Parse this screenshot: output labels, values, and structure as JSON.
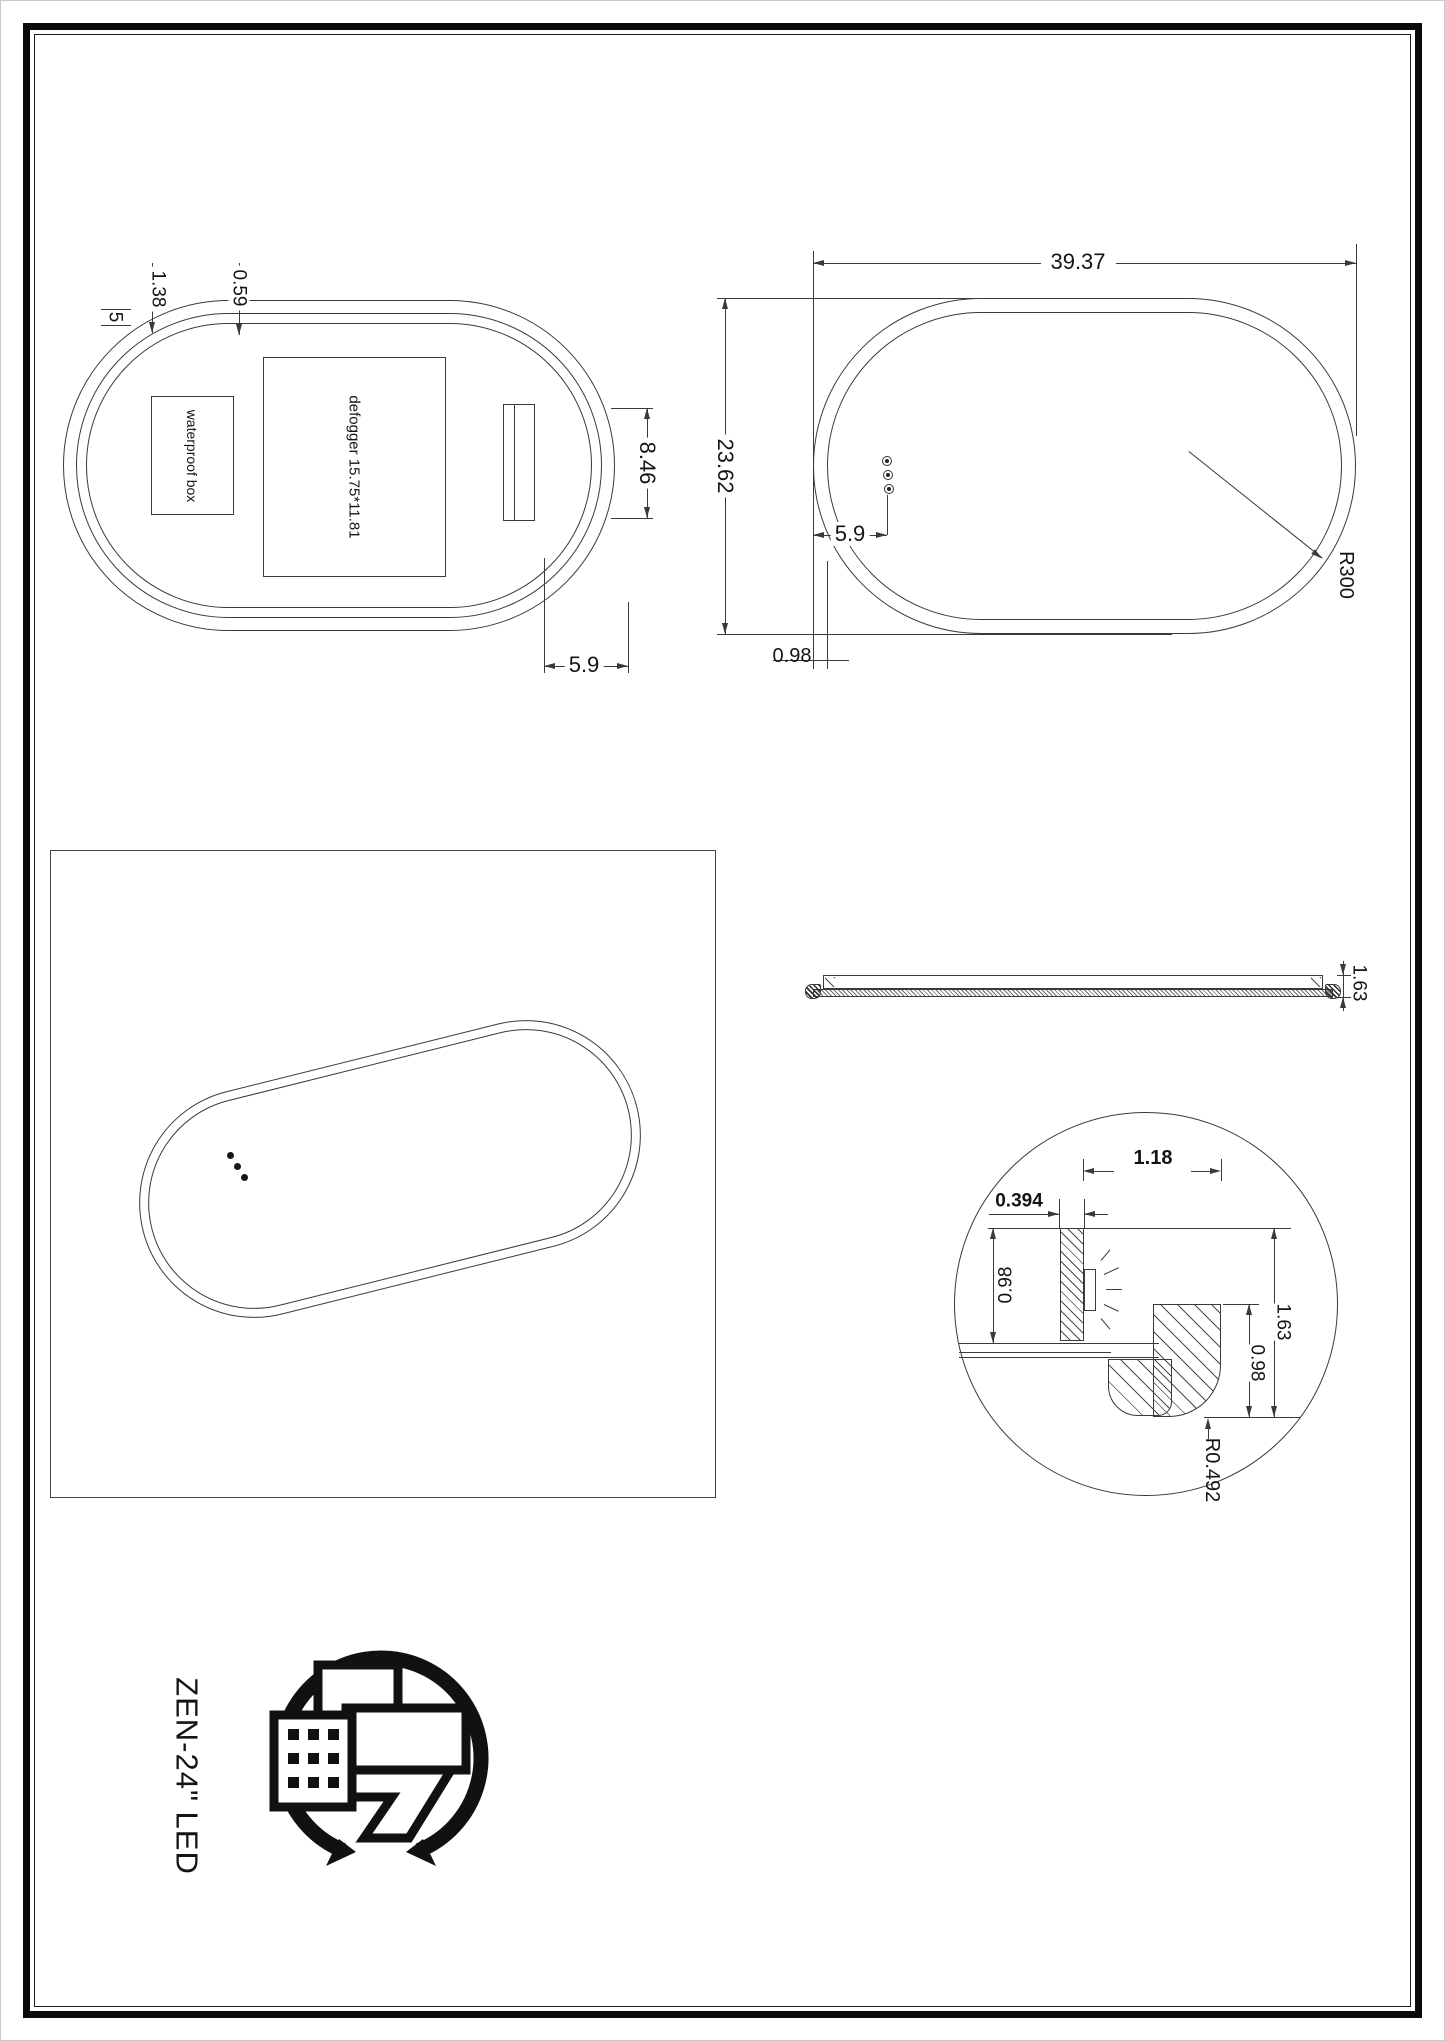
{
  "colors": {
    "line": "#3a3a3a",
    "text": "#141414",
    "frame": "#0b0b0b"
  },
  "rear_view": {
    "dims": {
      "edge_gap": "5",
      "flange": "1.38",
      "inner_offset": "0.59",
      "bracket_height": "8.46",
      "corner_offset": "5.9"
    },
    "labels": {
      "waterproof_box": "waterproof box",
      "defogger": "defogger 15.75*11.81"
    }
  },
  "front_view": {
    "dims": {
      "width": "39.37",
      "height": "23.62",
      "sensor_offset": "5.9",
      "frame_width": "0.98",
      "corner_radius": "R300"
    }
  },
  "side_view": {
    "dims": {
      "thickness": "1.63"
    }
  },
  "detail_view": {
    "dims": {
      "led_offset": "1.18",
      "led_width": "0.394",
      "wall_height": "0.98",
      "frame_height": "0.98",
      "frame_depth": "1.63",
      "corner_radius": "R0.492"
    }
  },
  "branding": {
    "product_name": "ZEN-24\" LED"
  }
}
